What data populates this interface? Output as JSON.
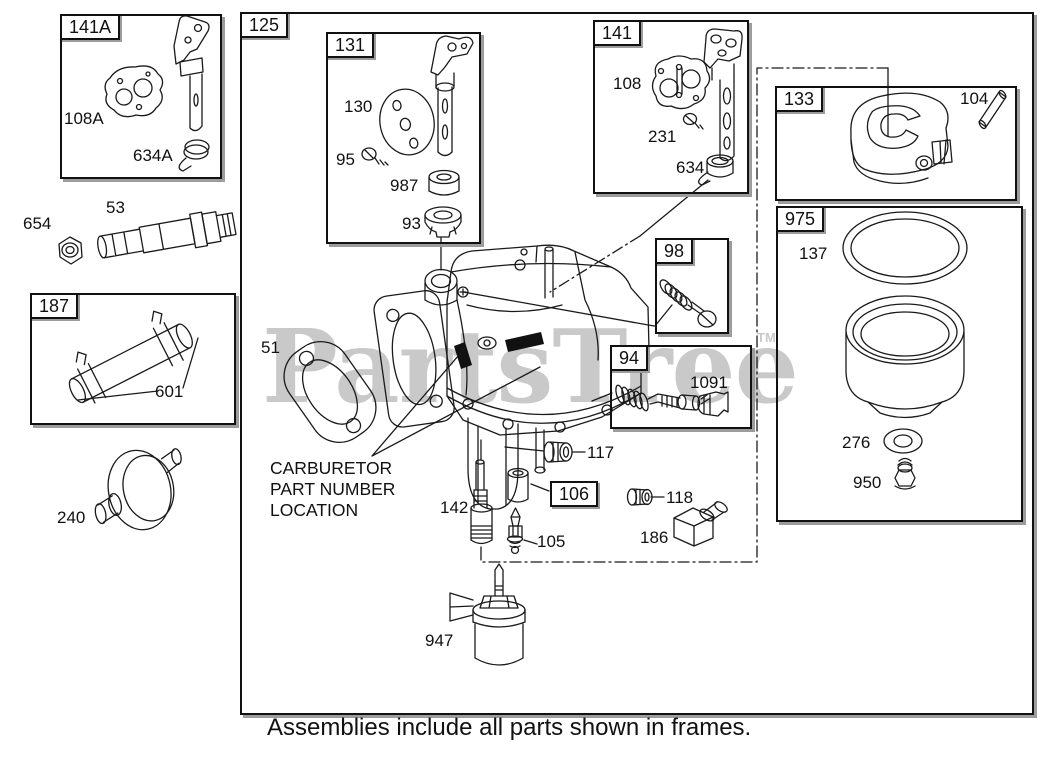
{
  "page": {
    "caption": "Assemblies include all parts shown in frames.",
    "watermark": {
      "text": "PartsTree",
      "tm": "TM"
    },
    "note": {
      "line1": "CARBURETOR",
      "line2": "PART NUMBER",
      "line3": "LOCATION"
    }
  },
  "colors": {
    "line": "#1a1a1a",
    "frame_shadow": "#9c9c9c",
    "watermark": "#c9c9c9"
  },
  "frames": {
    "f141A": "141A",
    "f187": "187",
    "f125": "125",
    "f131": "131",
    "f141": "141",
    "f133": "133",
    "f975": "975",
    "f98": "98",
    "f94": "94",
    "f106": "106"
  },
  "parts": {
    "p108A": "108A",
    "p634A": "634A",
    "p654": "654",
    "p53": "53",
    "p601": "601",
    "p240": "240",
    "p51": "51",
    "p130": "130",
    "p95": "95",
    "p987": "987",
    "p93": "93",
    "p108": "108",
    "p231": "231",
    "p634": "634",
    "p104": "104",
    "p137": "137",
    "p276": "276",
    "p950": "950",
    "p1091": "1091",
    "p117": "117",
    "p118": "118",
    "p105": "105",
    "p142": "142",
    "p186": "186",
    "p947": "947"
  }
}
